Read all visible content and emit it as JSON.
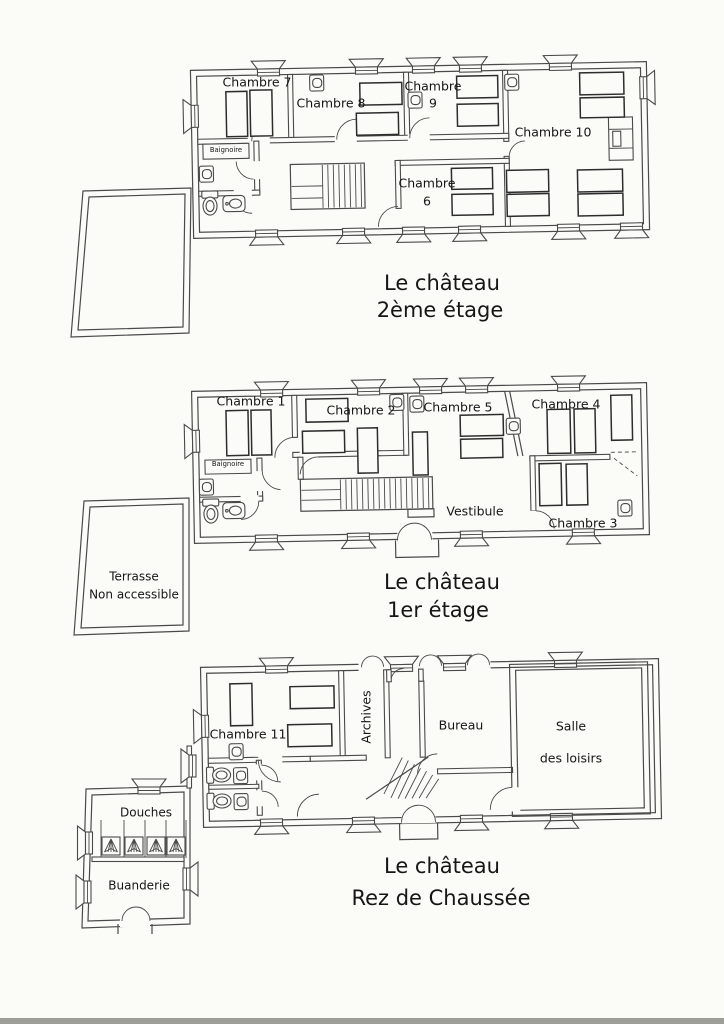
{
  "colors": {
    "ink": "#4a4a4a",
    "paper": "#fbfbf8",
    "text": "#161616"
  },
  "floor2": {
    "title1": "Le château",
    "title2": "2ème étage",
    "chambre7": "Chambre 7",
    "chambre8": "Chambre 8",
    "chambre9_word": "Chambre",
    "chambre9_num": "9",
    "chambre10": "Chambre 10",
    "chambre6_word": "Chambre",
    "chambre6_num": "6",
    "baignoire": "Baignoire"
  },
  "floor1": {
    "title1": "Le château",
    "title2": "1er étage",
    "chambre1": "Chambre 1",
    "chambre2": "Chambre 2",
    "chambre5": "Chambre 5",
    "chambre4": "Chambre 4",
    "chambre3": "Chambre 3",
    "vestibule": "Vestibule",
    "baignoire": "Baignoire",
    "terrasse1": "Terrasse",
    "terrasse2": "Non accessible"
  },
  "floor0": {
    "title1": "Le château",
    "title2": "Rez de Chaussée",
    "chambre11": "Chambre 11",
    "archives": "Archives",
    "bureau": "Bureau",
    "salle1": "Salle",
    "salle2": "des loisirs",
    "douches": "Douches",
    "buanderie": "Buanderie"
  }
}
